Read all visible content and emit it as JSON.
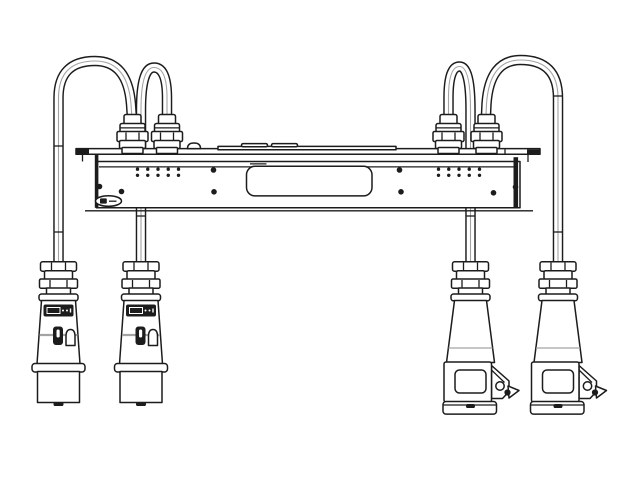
{
  "figure": {
    "title": "Technical line drawing: rack-mount power distribution unit with four attached cables arching from top cable glands to industrial power connectors (two plugs left, two covered sockets right)",
    "colors": {
      "canvas": "#ffffff",
      "line": "#1c1c1c",
      "fill": "#ffffff",
      "shade": "#a3a3a3"
    },
    "counts": {
      "cables": 4,
      "top_cable_glands": 4,
      "led_indicator_groups": 2,
      "led_columns_per_group": 5,
      "led_rows_per_group": 2,
      "panel_screws": 8,
      "left_plug_connectors": 2,
      "right_socket_connectors": 2
    }
  }
}
